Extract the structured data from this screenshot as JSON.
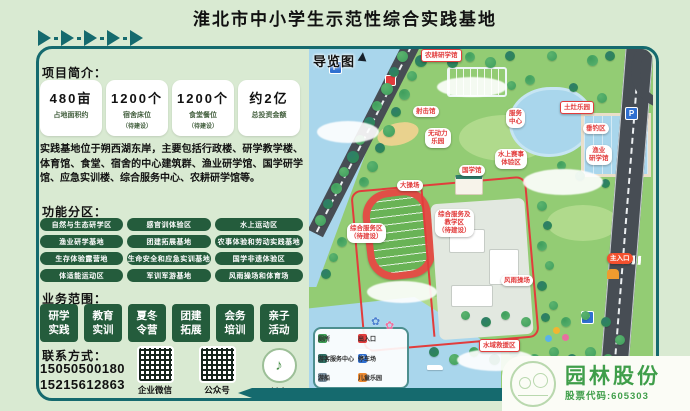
{
  "page": {
    "title": "淮北市中小学生示范性综合实践基地"
  },
  "colors": {
    "accent_teal": "#156a6e",
    "deep_green": "#245c3c",
    "label_red": "#e23c3c",
    "brand_green": "#3f9e4a",
    "water_blue": "#a9d6ec",
    "land_green": "#93cc74",
    "page_bg": "#d9ead2"
  },
  "intro": {
    "heading": "项目简介：",
    "stats": [
      {
        "value": "480亩",
        "label": "占地面积约",
        "note": ""
      },
      {
        "value": "1200个",
        "label": "宿舍床位",
        "note": "（待建设）"
      },
      {
        "value": "1200个",
        "label": "食堂餐位",
        "note": "（待建设）"
      },
      {
        "value": "约2亿",
        "label": "总投资金额",
        "note": ""
      }
    ],
    "description": "实践基地位于朔西湖东岸，主要包括行政楼、研学教学楼、体育馆、食堂、宿舍的中心建筑群、渔业研学馆、国学研学馆、应急实训楼、综合服务中心、农耕研学馆等。"
  },
  "zones": {
    "heading": "功能分区：",
    "items": [
      "自然与生态研学区",
      "感官训体验区",
      "水上运动区",
      "渔业研学基地",
      "团建拓展基地",
      "农事体验和劳动实践基地",
      "生存体验露营地",
      "生命安全和应急实训基地",
      "国学非遗体验区",
      "体适能运动区",
      "军训军游基地",
      "风雨操场和体育场"
    ]
  },
  "business": {
    "heading": "业务范围：",
    "items": [
      "研学\n实践",
      "教育\n实训",
      "夏冬\n令营",
      "团建\n拓展",
      "会务\n培训",
      "亲子\n活动"
    ]
  },
  "contact": {
    "heading": "联系方式：",
    "phones": [
      "15050500180",
      "15215612863"
    ],
    "qr": [
      {
        "label": "企业微信"
      },
      {
        "label": "公众号"
      },
      {
        "label": "抖音"
      }
    ]
  },
  "map": {
    "title": "导览图",
    "labels": [
      {
        "text": "农耕研学馆",
        "kind": "tag"
      },
      {
        "text": "射击馆",
        "kind": "cloud"
      },
      {
        "text": "无动力\n乐园",
        "kind": "cloud"
      },
      {
        "text": "服务\n中心",
        "kind": "cloud"
      },
      {
        "text": "土灶乐园",
        "kind": "tag"
      },
      {
        "text": "垂钓区",
        "kind": "cloud"
      },
      {
        "text": "渔业\n研学馆",
        "kind": "cloud"
      },
      {
        "text": "水上赛事\n体验区",
        "kind": "cloud"
      },
      {
        "text": "大操场",
        "kind": "cloud"
      },
      {
        "text": "国学馆",
        "kind": "cloud"
      },
      {
        "text": "综合服务区\n（待建设）",
        "kind": "cloud"
      },
      {
        "text": "综合服务及\n教学区\n（待建设）",
        "kind": "cloud"
      },
      {
        "text": "风雨操场",
        "kind": "cloud"
      },
      {
        "text": "主入口",
        "kind": "entrance"
      },
      {
        "text": "水域救援区",
        "kind": "tag"
      }
    ],
    "legend": {
      "items": [
        {
          "icon": "toilet-icon",
          "label": "厕所",
          "color": "#3fa057"
        },
        {
          "icon": "entrance-icon",
          "label": "出入口",
          "color": "#e23c3c"
        },
        {
          "icon": "visitor-center-icon",
          "label": "游客服务中心",
          "color": "#2f6e63"
        },
        {
          "icon": "parking-icon",
          "label": "停车场",
          "color": "#2f6fd0"
        },
        {
          "icon": "boat-icon",
          "label": "游船",
          "color": "#7a8f9e"
        },
        {
          "icon": "playground-icon",
          "label": "儿童乐园",
          "color": "#ef8b31"
        }
      ]
    },
    "compass": "north-arrow-icon"
  },
  "footer": {
    "brand": "园林股份",
    "stock": "股票代码:605303"
  }
}
